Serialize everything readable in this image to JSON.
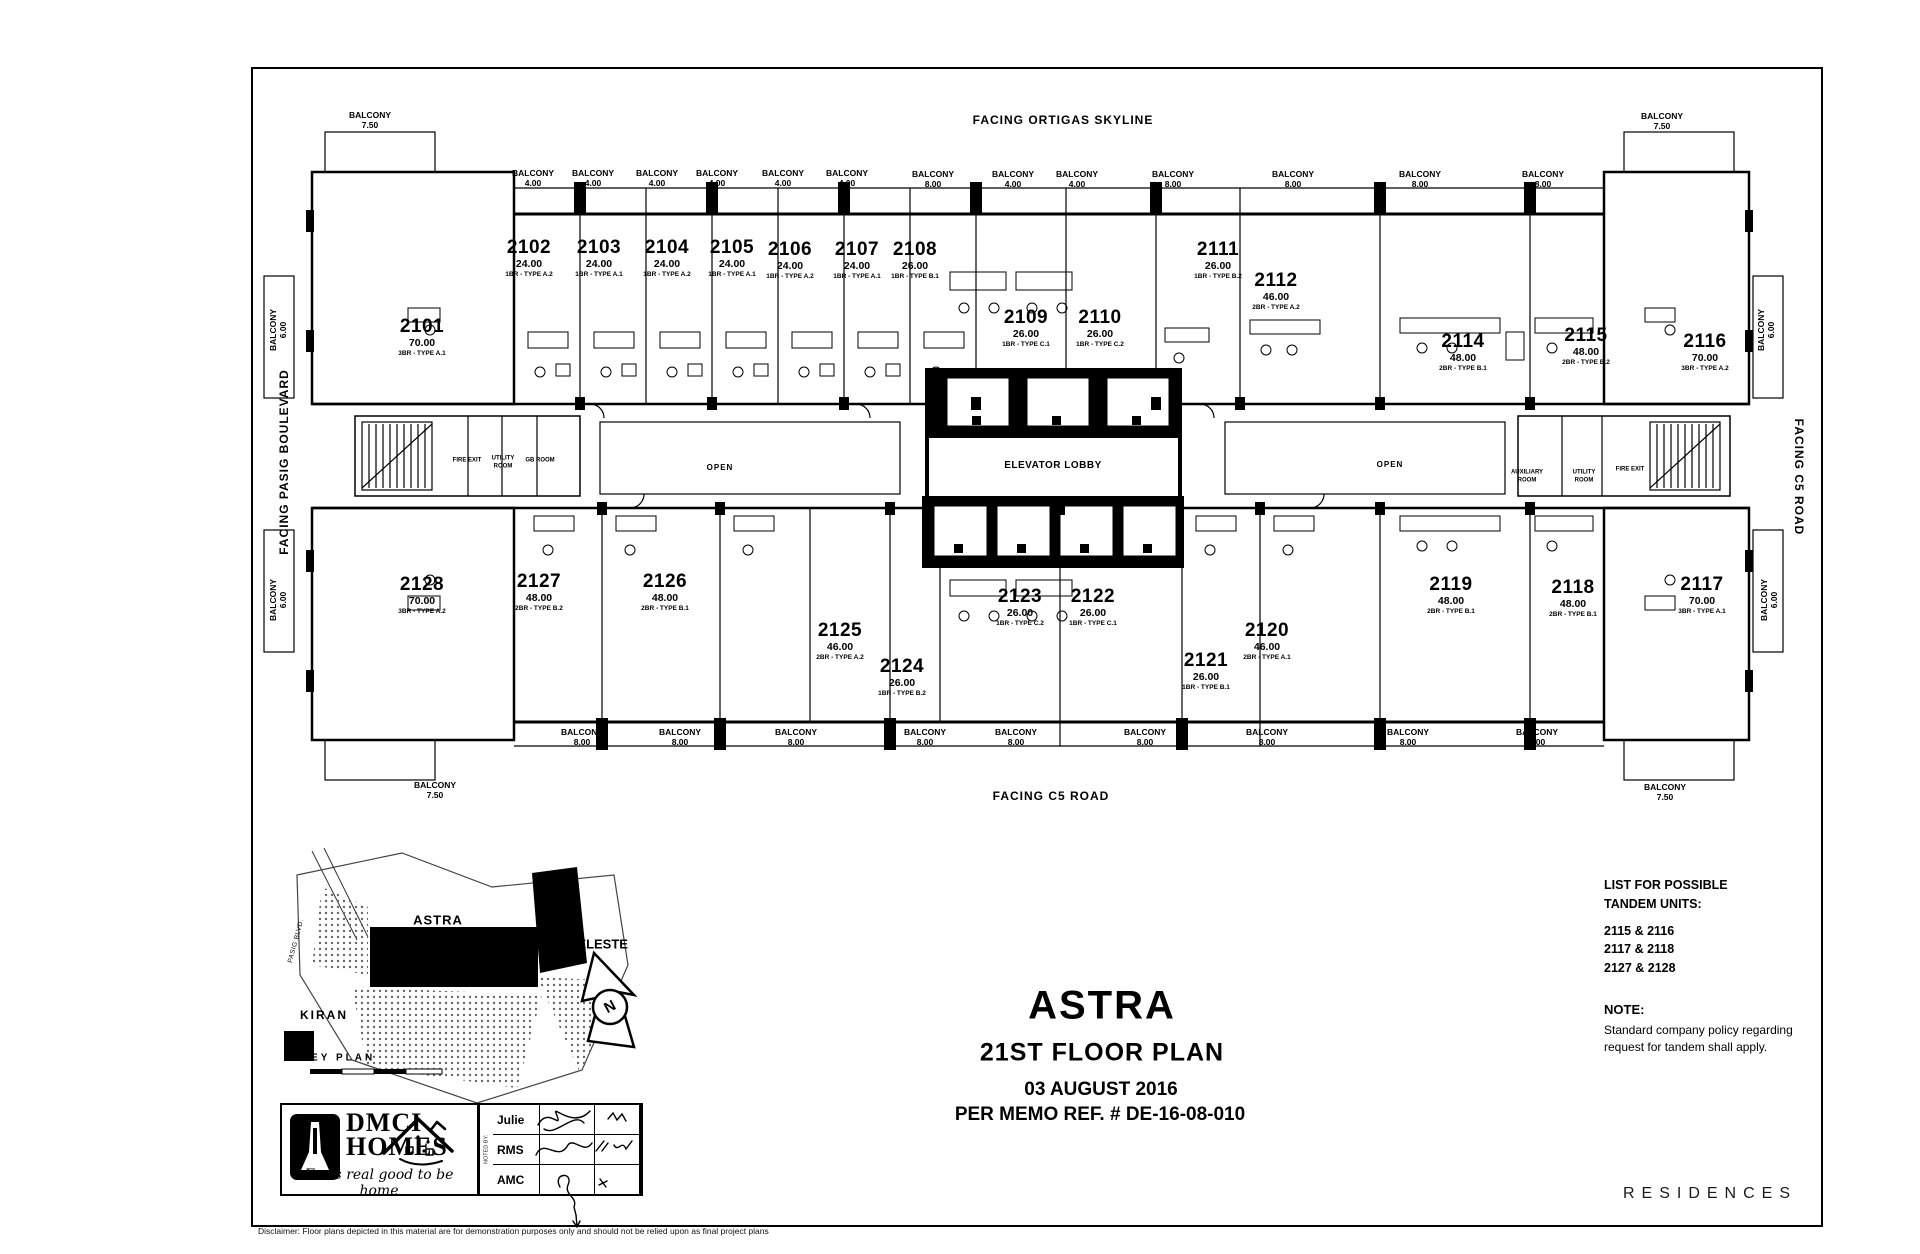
{
  "document": {
    "facing_top": "FACING ORTIGAS SKYLINE",
    "facing_left": "FACING PASIG BOULEVARD",
    "facing_right": "FACING C5 ROAD",
    "facing_bottom": "FACING C5 ROAD",
    "balcony": "BALCONY",
    "open": "OPEN",
    "elevator_lobby": "ELEVATOR LOBBY",
    "fire_exit": "FIRE EXIT",
    "utility_room": "UTILITY ROOM",
    "gb_room": "GB ROOM",
    "auxiliary_room": "AUXILIARY ROOM"
  },
  "units": [
    {
      "no": "2101",
      "area": "70.00",
      "type": "3BR - TYPE A.1"
    },
    {
      "no": "2102",
      "area": "24.00",
      "type": "1BR - TYPE A.2"
    },
    {
      "no": "2103",
      "area": "24.00",
      "type": "1BR - TYPE A.1"
    },
    {
      "no": "2104",
      "area": "24.00",
      "type": "1BR - TYPE A.2"
    },
    {
      "no": "2105",
      "area": "24.00",
      "type": "1BR - TYPE A.1"
    },
    {
      "no": "2106",
      "area": "24.00",
      "type": "1BR - TYPE A.2"
    },
    {
      "no": "2107",
      "area": "24.00",
      "type": "1BR - TYPE A.1"
    },
    {
      "no": "2108",
      "area": "26.00",
      "type": "1BR - TYPE B.1"
    },
    {
      "no": "2109",
      "area": "26.00",
      "type": "1BR - TYPE C.1"
    },
    {
      "no": "2110",
      "area": "26.00",
      "type": "1BR - TYPE C.2"
    },
    {
      "no": "2111",
      "area": "26.00",
      "type": "1BR - TYPE B.2"
    },
    {
      "no": "2112",
      "area": "46.00",
      "type": "2BR - TYPE A.2"
    },
    {
      "no": "2114",
      "area": "48.00",
      "type": "2BR - TYPE B.1"
    },
    {
      "no": "2115",
      "area": "48.00",
      "type": "2BR - TYPE B.2"
    },
    {
      "no": "2116",
      "area": "70.00",
      "type": "3BR - TYPE A.2"
    },
    {
      "no": "2117",
      "area": "70.00",
      "type": "3BR - TYPE A.1"
    },
    {
      "no": "2118",
      "area": "48.00",
      "type": "2BR - TYPE B.1"
    },
    {
      "no": "2119",
      "area": "48.00",
      "type": "2BR - TYPE B.1"
    },
    {
      "no": "2120",
      "area": "46.00",
      "type": "2BR - TYPE A.1"
    },
    {
      "no": "2121",
      "area": "26.00",
      "type": "1BR - TYPE B.1"
    },
    {
      "no": "2122",
      "area": "26.00",
      "type": "1BR - TYPE C.1"
    },
    {
      "no": "2123",
      "area": "26.00",
      "type": "1BR - TYPE C.2"
    },
    {
      "no": "2124",
      "area": "26.00",
      "type": "1BR - TYPE B.2"
    },
    {
      "no": "2125",
      "area": "46.00",
      "type": "2BR - TYPE A.2"
    },
    {
      "no": "2126",
      "area": "48.00",
      "type": "2BR - TYPE B.1"
    },
    {
      "no": "2127",
      "area": "48.00",
      "type": "2BR - TYPE B.2"
    },
    {
      "no": "2128",
      "area": "70.00",
      "type": "3BR - TYPE A.2"
    }
  ],
  "balconies": {
    "top": [
      "7.50",
      "4.00",
      "4.00",
      "4.00",
      "4.00",
      "4.00",
      "4.00",
      "8.00",
      "4.00",
      "4.00",
      "8.00",
      "8.00",
      "8.00",
      "8.00",
      "7.50"
    ],
    "bottom": [
      "7.50",
      "8.00",
      "8.00",
      "8.00",
      "8.00",
      "8.00",
      "8.00",
      "8.00",
      "8.00",
      "8.00",
      "7.50"
    ],
    "side": "6.00"
  },
  "keyplan": {
    "title": "KEY PLAN",
    "astra": "ASTRA",
    "celeste": "CELESTE",
    "kiran": "KIRAN",
    "road": "PASIG BLVD.",
    "north": "N"
  },
  "title_block": {
    "project": "ASTRA",
    "floor": "21ST FLOOR PLAN",
    "date": "03 AUGUST 2016",
    "memo": "PER MEMO REF. # DE-16-08-010"
  },
  "tandem": {
    "line1": "LIST FOR POSSIBLE",
    "line2": "TANDEM UNITS:",
    "pairs": [
      "2115 & 2116",
      "2117 & 2118",
      "2127 & 2128"
    ]
  },
  "note": {
    "title": "NOTE:",
    "line1": "Standard company policy regarding",
    "line2": "request for tandem shall apply."
  },
  "brand": {
    "name_line1": "DMCI",
    "name_line2": "HOMES",
    "tagline": "Feels real good to be home",
    "residences": "RESIDENCES"
  },
  "signoff": {
    "side_label": "NOTED BY:",
    "rows": [
      "Julie",
      "RMS",
      "AMC"
    ]
  },
  "disclaimer": "Disclaimer:  Floor plans depicted in this material are for demonstration purposes only and should not be relied upon as final project plans"
}
